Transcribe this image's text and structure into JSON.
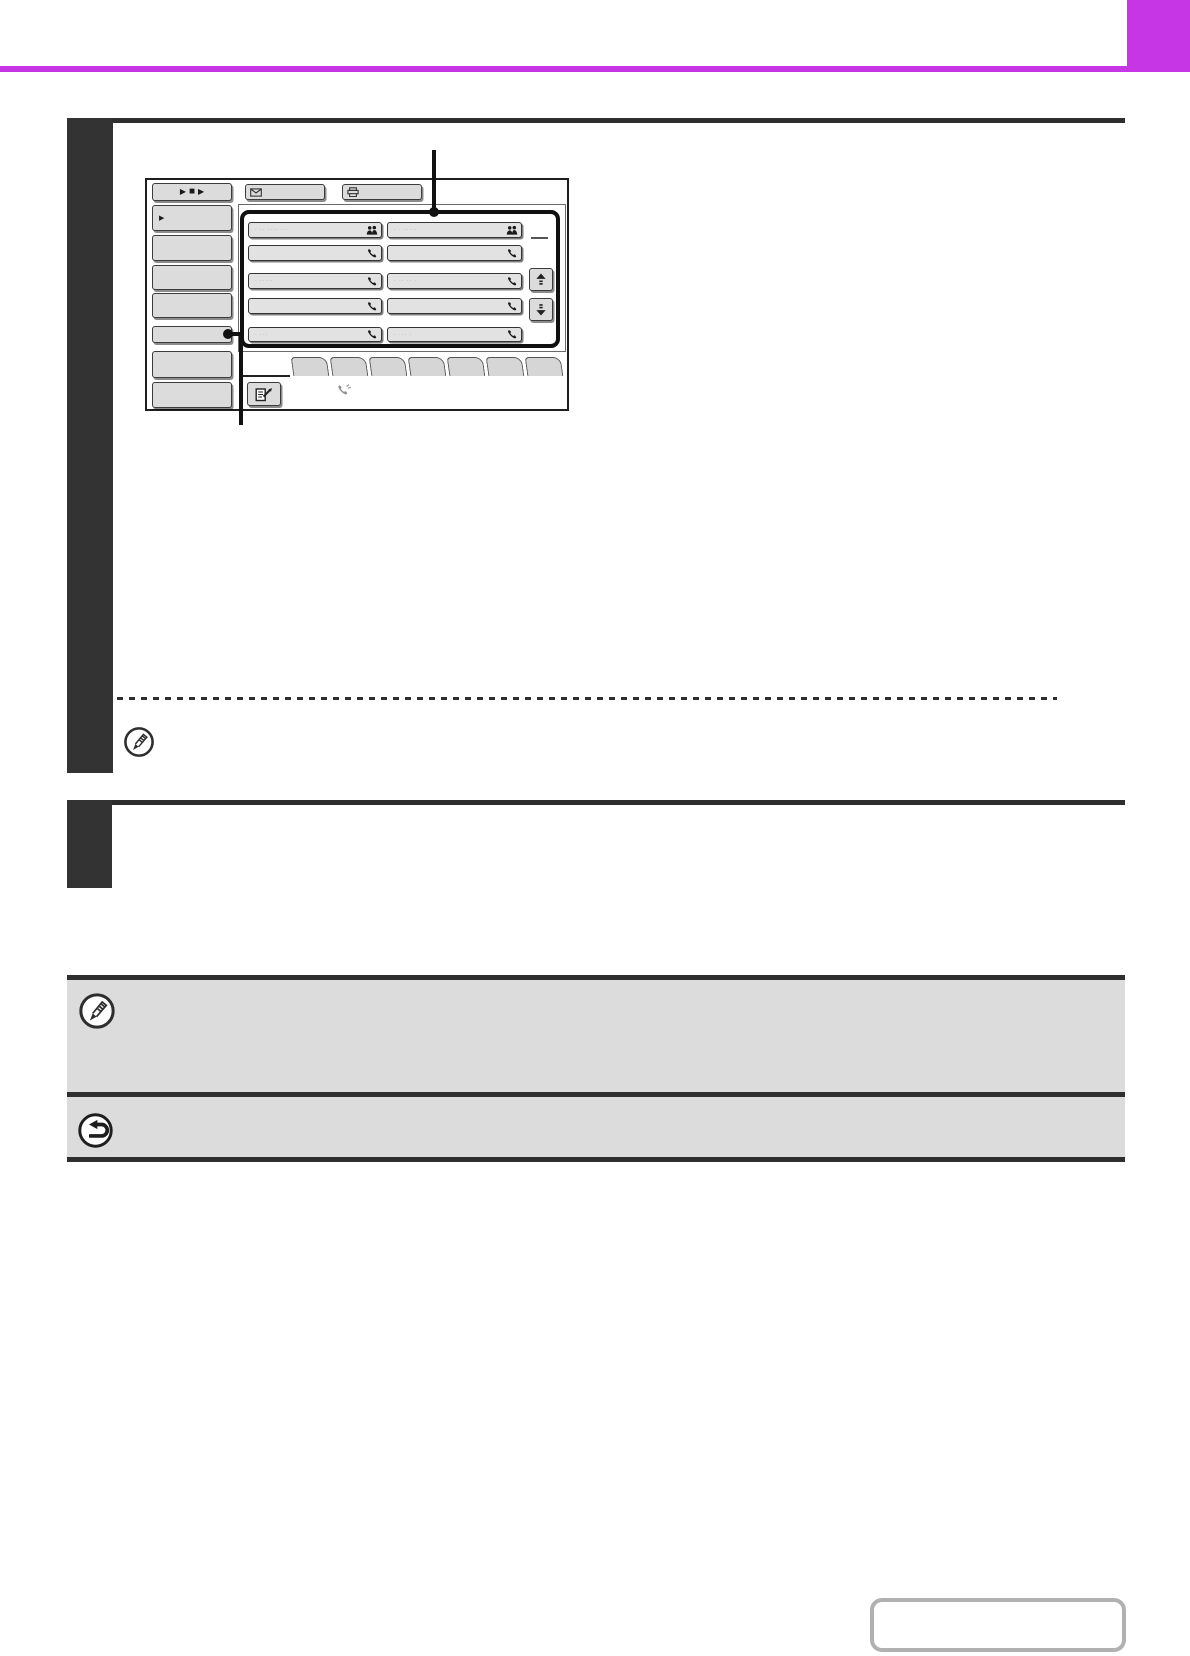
{
  "colors": {
    "accent_magenta": "#c636e4",
    "sidebar_dark": "#333333",
    "rule_dark": "#2e2e2e",
    "note_box_fill": "#dcdcdc",
    "touch_button_fill": "#dcdcdc",
    "outline_button_border": "#b1b1b1"
  },
  "icons": {
    "play": "▶",
    "stop": "■",
    "menu_arrow": "▶"
  },
  "touch_panel": {
    "left_menu_button_count": 7,
    "tab_count": 8,
    "one_touch_keys": [
      {
        "label": "· ·· ···· ···",
        "icon": "group-icon"
      },
      {
        "label": "· · ·····",
        "icon": "group-icon"
      },
      {
        "label": "",
        "icon": "phone-icon"
      },
      {
        "label": "",
        "icon": "phone-icon"
      },
      {
        "label": "· ·····",
        "icon": "phone-icon"
      },
      {
        "label": "· ·· ·· ·",
        "icon": "phone-icon"
      },
      {
        "label": "",
        "icon": "phone-icon"
      },
      {
        "label": "",
        "icon": "phone-icon"
      },
      {
        "label": "· ···",
        "icon": "phone-icon"
      },
      {
        "label": "· ··· ·",
        "icon": "phone-icon"
      }
    ]
  }
}
